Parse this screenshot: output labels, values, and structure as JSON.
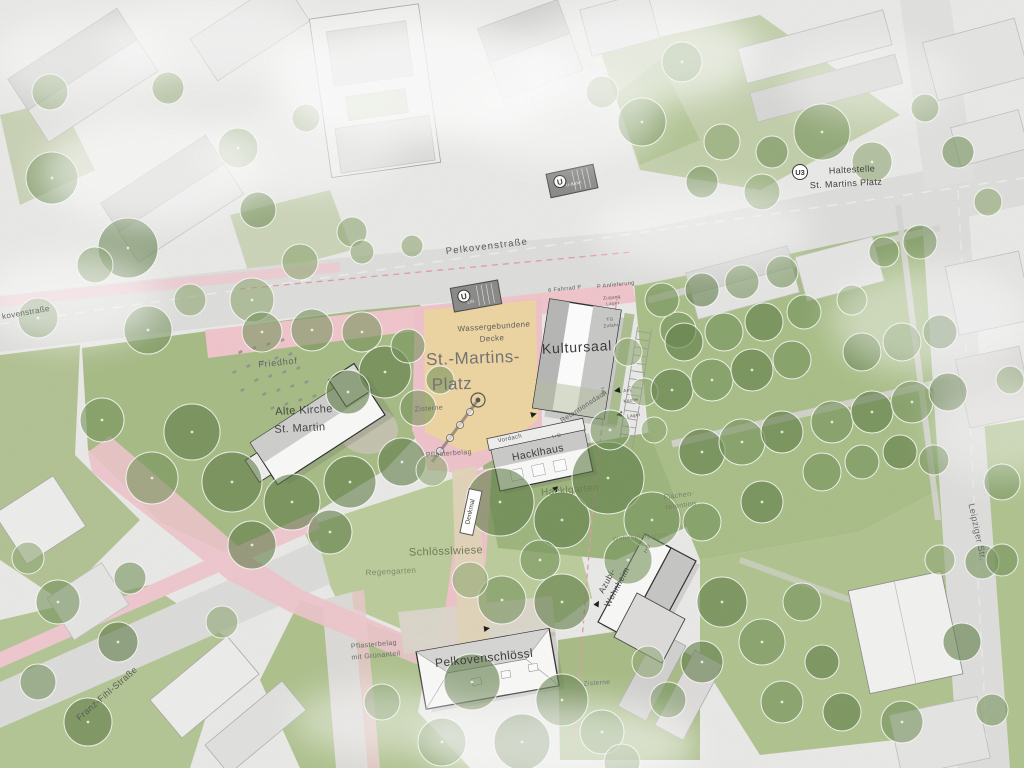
{
  "streets": {
    "pelkovenstrasse": "Pelkovenstraße",
    "pelkovenstrasse_left": "kovenstraße",
    "leipziger": "Leipziger Str.",
    "franz_fihl": "Franz-Fihl-Straße"
  },
  "transit": {
    "u3_badge": "U3",
    "stop_line1": "Haltestelle",
    "stop_line2": "St. Martins Platz",
    "u_logo": "U",
    "entrance_lift": "Lift",
    "entrance_bahn": "U-Bahn"
  },
  "plaza": {
    "platz_line1": "St.-Martins-",
    "platz_line2": "Platz",
    "surface_line1": "Wassergebundene",
    "surface_line2": "Decke",
    "zisterne": "Zisterne",
    "pflasterbelag": "Pflasterbelag",
    "denkmal": "Denkmal"
  },
  "buildings": {
    "kultursaal": "Kultursaal",
    "kirche_line1": "Alte Kirche",
    "kirche_line2": "St. Martin",
    "hacklhaus": "Hacklhaus",
    "vordach": "Vordach",
    "azubi_line1": "Azubi-",
    "azubi_line2": "Wohnheim",
    "pelkovenschloessl": "Pelkovenschlössl",
    "id_tag": "I+D",
    "retentionsdach": "Retentionsdach"
  },
  "landscape": {
    "friedhof": "Friedhof",
    "hacklgarten": "Hacklgarten",
    "flaechen_line1": "Flächen-",
    "flaechen_line2": "retention",
    "schloesslwiese": "Schlösslwiese",
    "regengarten": "Regengarten",
    "wohnheimgarten": "Wohnheimgarten",
    "pflaster_gruen_line1": "Pflasterbelag",
    "pflaster_gruen_line2": "mit Grünanteil",
    "zisterne2": "Zisterne"
  },
  "annotations": {
    "fahrrad": "6 Fahrrad P",
    "anlieferung": "P Anlieferung",
    "zugang_line1": "Zugang",
    "zugang_line2": "Lager",
    "tg_line1": "TG",
    "tg_line2": "Zufahrt",
    "anl": "Anl.",
    "kueche": "Küche",
    "lager": "Lager"
  },
  "colors": {
    "plaza_pink": "#f2c6cd",
    "surface_tan": "#efd6a2",
    "lawn_green": "#aec28c",
    "tree_green": "#5d7b44",
    "road_gray": "#dfdfdd",
    "building_gray": "#e6e6e5",
    "outline": "#2e2e2e"
  }
}
